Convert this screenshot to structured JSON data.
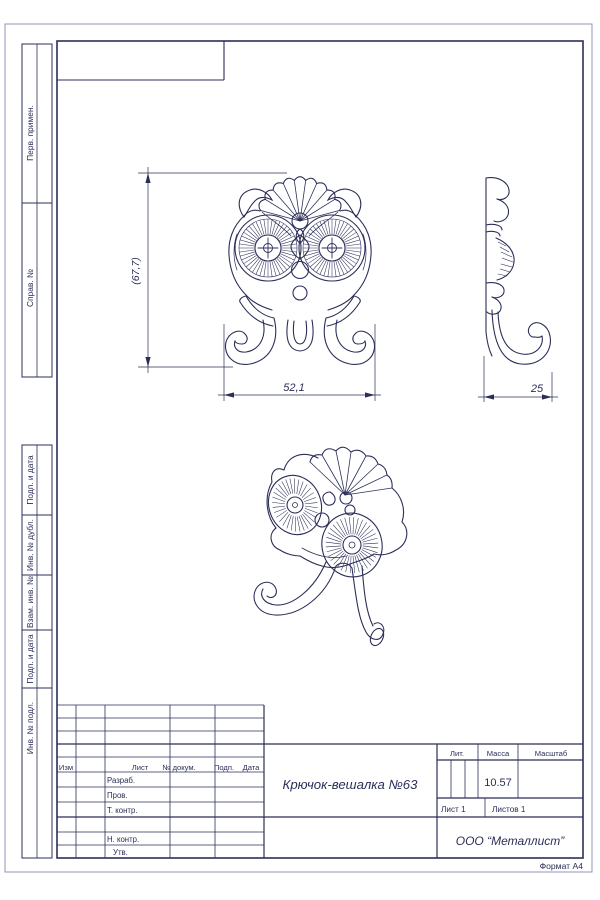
{
  "document": {
    "format_label": "Формат А4"
  },
  "sidebar": {
    "top": [
      "Перв. примен.",
      "Справ. №"
    ],
    "bottom": [
      "Подп. и дата",
      "Инв. № дубл.",
      "Взам. инв. №",
      "Подп. и дата",
      "Инв. № подл."
    ]
  },
  "title_block": {
    "header_cols": [
      "Изм",
      "Лист",
      "№ докум.",
      "Подп.",
      "Дата"
    ],
    "row_labels": [
      "Разраб.",
      "Пров.",
      "Т. контр.",
      "Н. контр.",
      "Утв."
    ],
    "lit_label": "Лит.",
    "mass_label": "Масса",
    "scale_label": "Масштаб",
    "mass_value": "10.57",
    "sheet_info": "Лист 1",
    "sheets_info": "Листов 1",
    "doc_title": "Крючок-вешалка №63",
    "company": "ООО “Металлист”"
  },
  "dimensions": {
    "height": "(67,7)",
    "width": "52,1",
    "depth": "25"
  },
  "colors": {
    "line": "#2b2f58",
    "paper": "#ffffff"
  }
}
